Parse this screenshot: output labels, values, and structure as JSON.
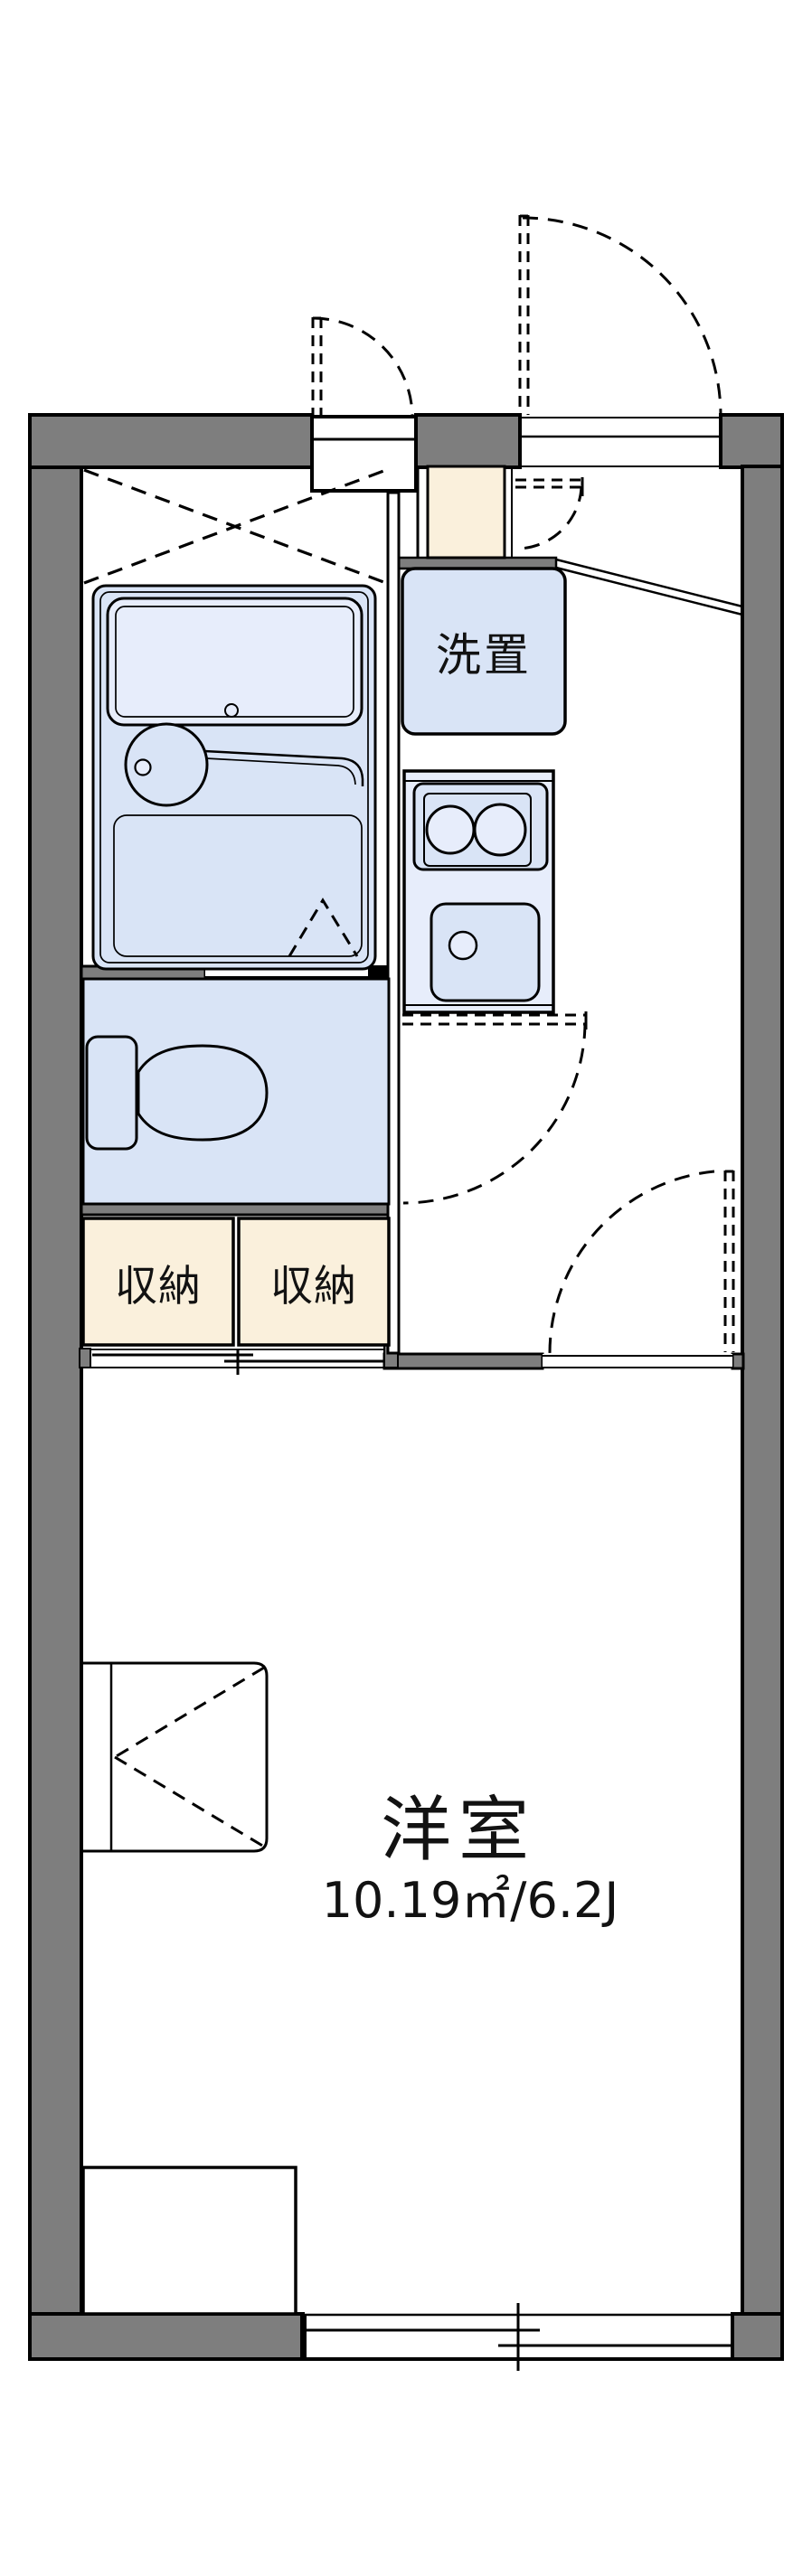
{
  "labels": {
    "washer": "洗置",
    "storage_left": "収納",
    "storage_right": "収納",
    "room_name": "洋室",
    "room_area": "10.19㎡/6.2J"
  },
  "colors": {
    "wall": "#7e7e7e",
    "line": "#000000",
    "fixture_blue": "#d9e4f6",
    "fixture_blue_light": "#e7edfb",
    "storage_cream": "#faf0dc",
    "background": "#ffffff"
  }
}
